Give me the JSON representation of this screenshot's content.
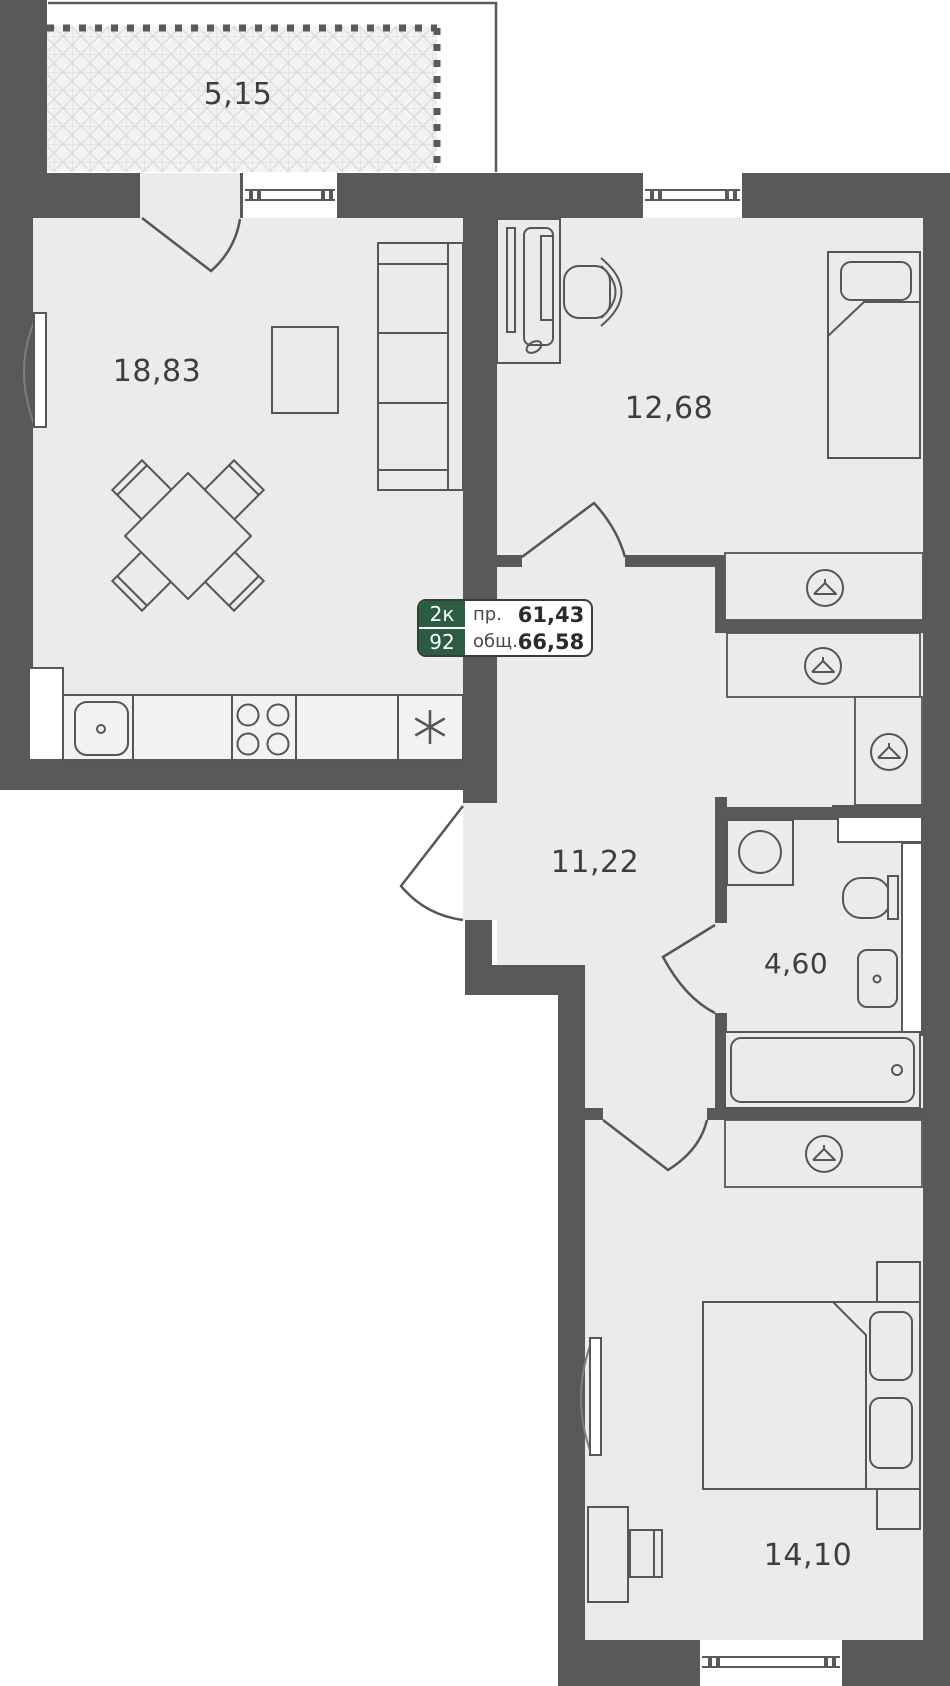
{
  "floorplan": {
    "unit_badge": {
      "rooms": "2к",
      "unit_number": "92",
      "living_label": "пр.",
      "living_area": "61,43",
      "total_label": "общ.",
      "total_area": "66,58"
    },
    "room_areas": {
      "balcony": "5,15",
      "living_room": "18,83",
      "bedroom_top": "12,68",
      "hallway": "11,22",
      "bathroom": "4,60",
      "bedroom_bottom": "14,10"
    },
    "icons": {
      "hanger": "clothes-hanger-in-circle",
      "fridge": "six-spoke-asterisk",
      "stove": "four-burner-circles",
      "sink": "rounded-basin-with-tap-dot"
    },
    "colors": {
      "wall": "#595959",
      "floor": "#ebebeb",
      "counter": "#f2f2f2",
      "accent_green": "#2c5c42",
      "furniture_line": "#55555a",
      "label_text": "#3e3e40"
    }
  }
}
